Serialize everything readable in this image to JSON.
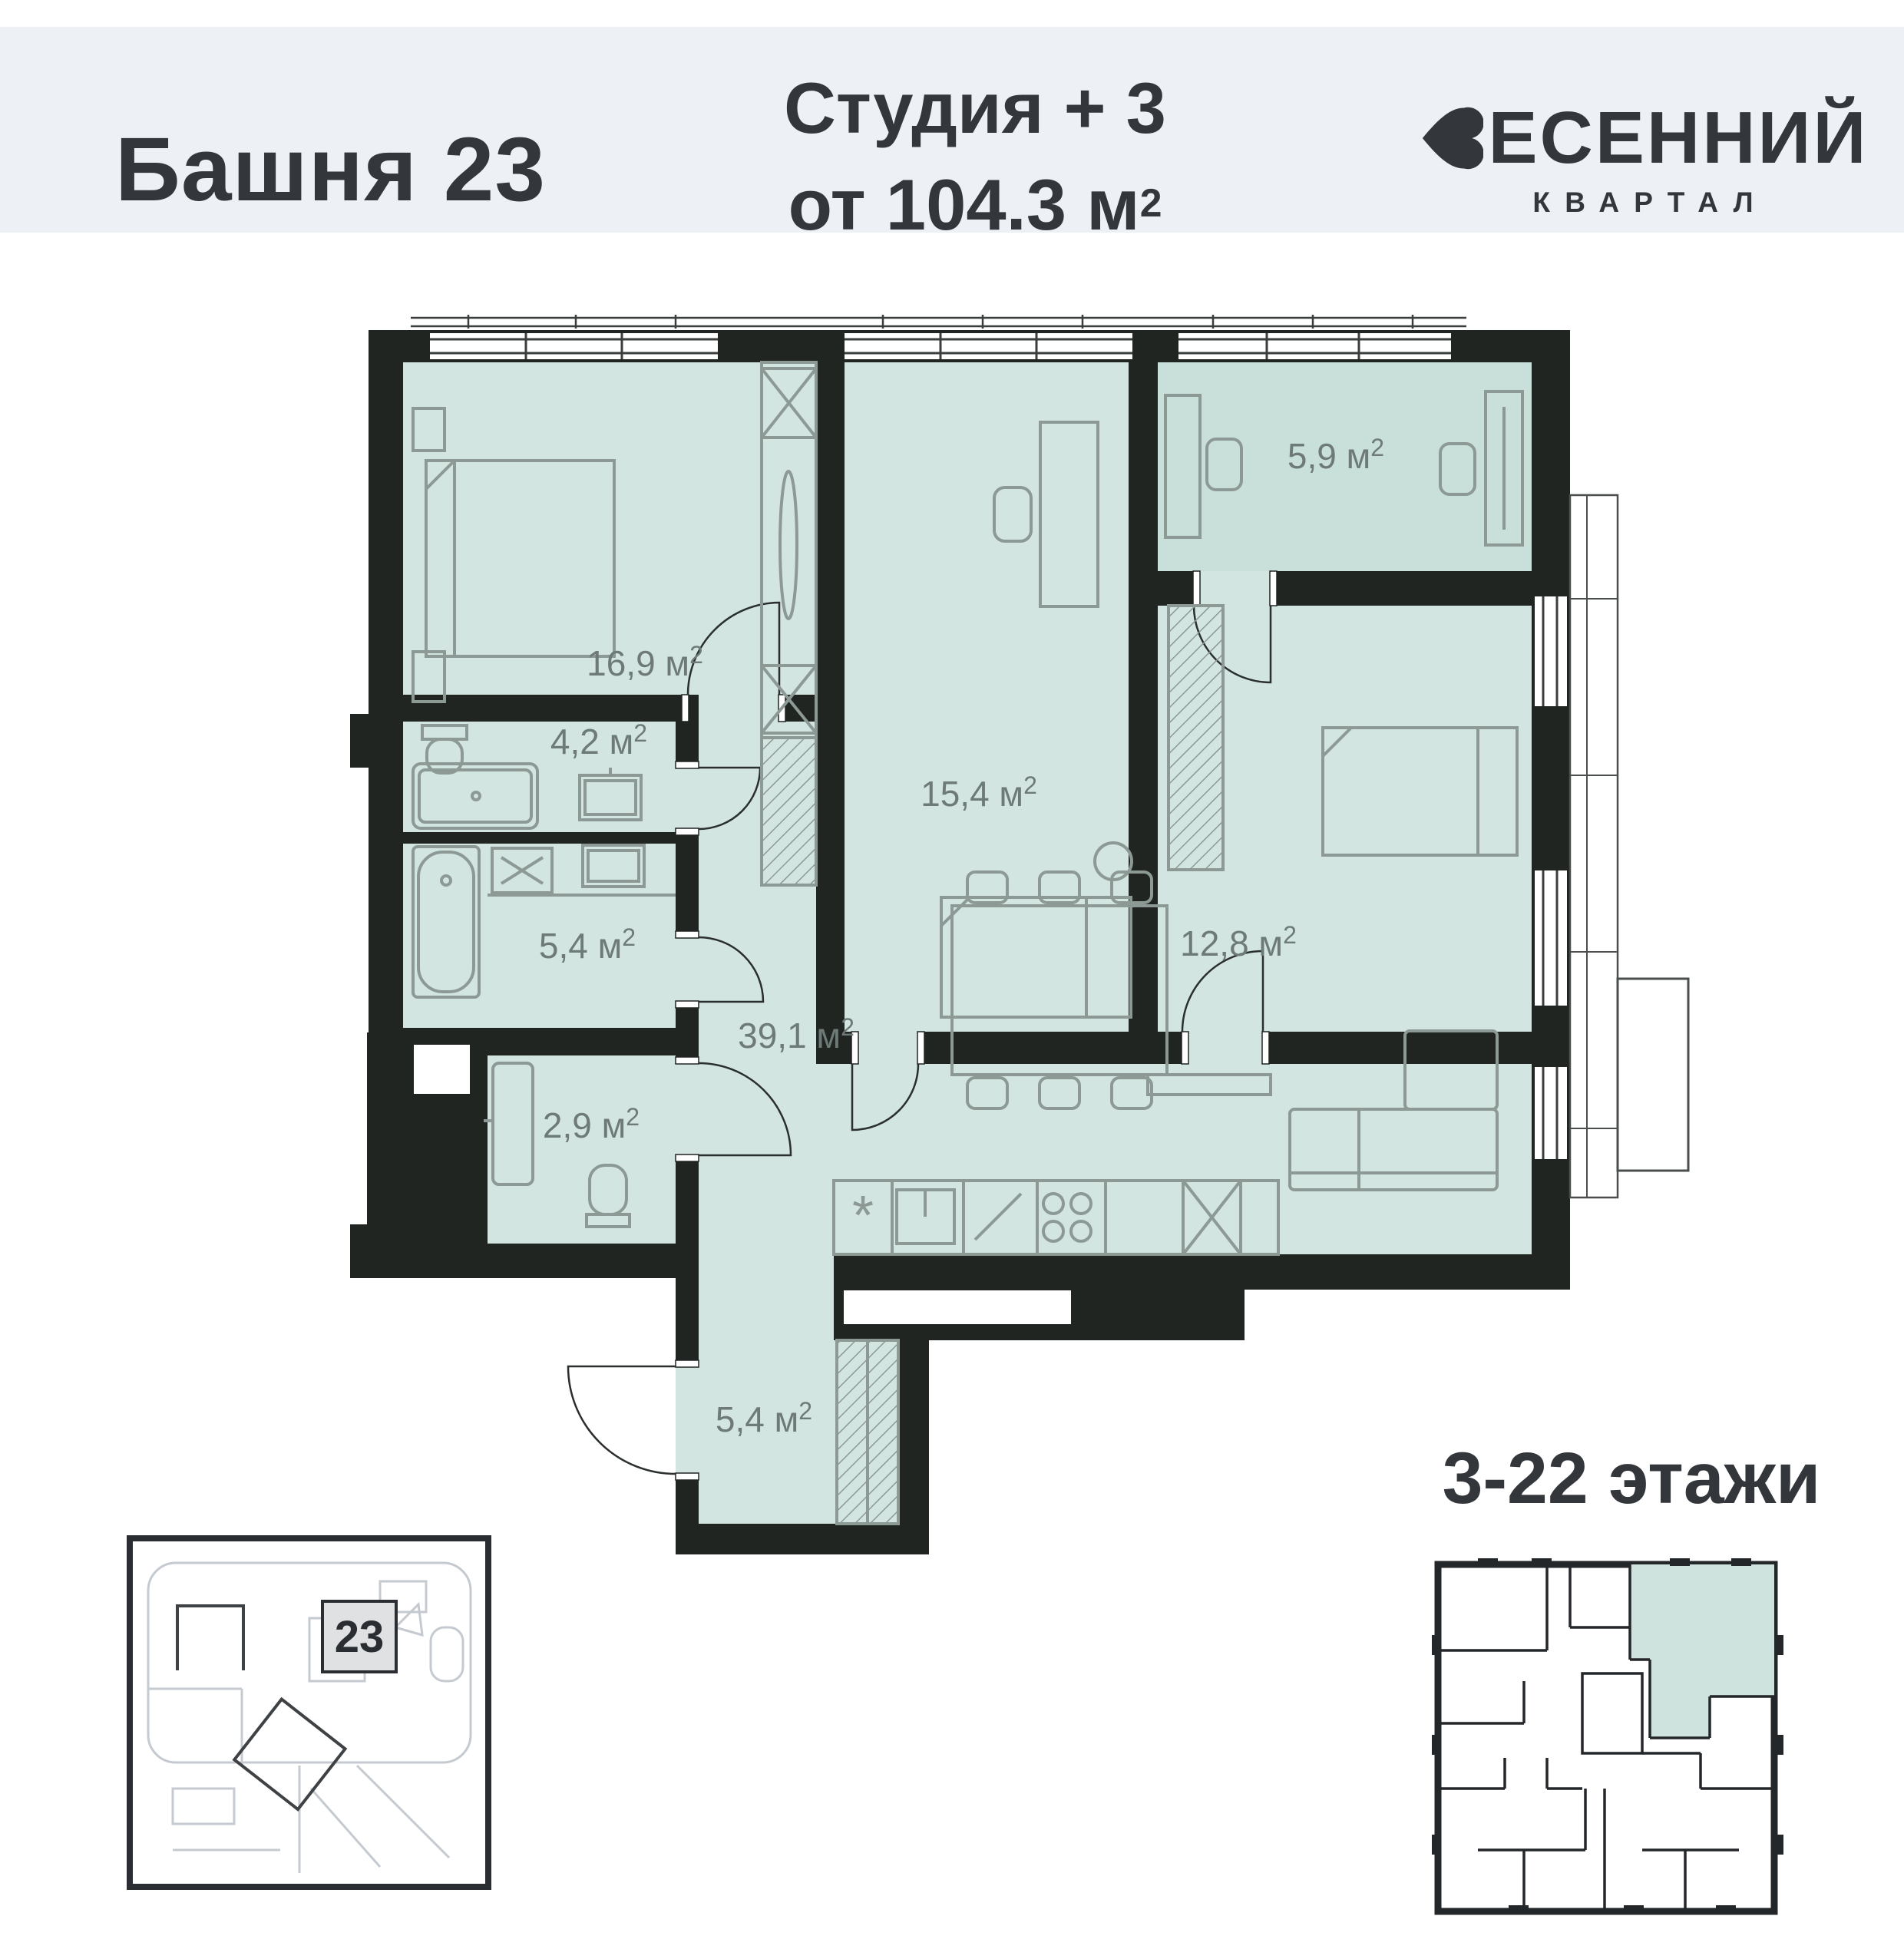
{
  "header": {
    "tower": "Башня 23",
    "layout_type": "Студия + 3",
    "area_from": "от 104.3 м",
    "brand": {
      "name_rest": "ЕСЕННИЙ",
      "sub": "КВАРТАЛ"
    }
  },
  "units": {
    "sup": "2"
  },
  "plan": {
    "rooms": {
      "bedroom1": {
        "label": "16,9 м"
      },
      "bath1": {
        "label": "4,2 м"
      },
      "bedroom2": {
        "label": "15,4 м"
      },
      "cabinet": {
        "label": "5,9 м"
      },
      "bedroom3": {
        "label": "12,8 м"
      },
      "bath2": {
        "label": "5,4 м"
      },
      "living": {
        "label": "39,1 м"
      },
      "wc": {
        "label": "2,9 м"
      },
      "hall": {
        "label": "5,4 м"
      }
    },
    "icons": {
      "fridge_glyph": "*"
    }
  },
  "site_map": {
    "building_number": "23"
  },
  "floors": {
    "label": "3-22 этажи"
  },
  "colors": {
    "header_bg": "#edf0f4",
    "text_dark": "#33363b",
    "wall": "#202522",
    "room_teal": "#d2e5e1",
    "room_teal_dark": "#c9dfda",
    "furniture_gray": "#8d9995"
  }
}
